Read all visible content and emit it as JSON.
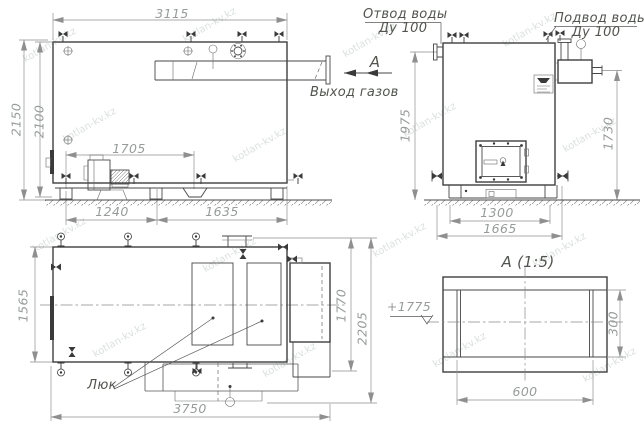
{
  "colors": {
    "background": "#ffffff",
    "main_line": "#3f3f3f",
    "dim_line": "#8f8f8f",
    "dim_text": "#979c99",
    "label_text": "#52554f",
    "watermark": "#a9b6ae"
  },
  "watermark": {
    "text": "kotlan-kv.kz"
  },
  "side_view": {
    "dims": {
      "w3115": "3115",
      "h2150": "2150",
      "h2100": "2100",
      "l1705": "1705",
      "l1240": "1240",
      "l1635": "1635"
    },
    "gas_outlet_label": "Выход газов",
    "view_arrow_label": "А"
  },
  "front_view": {
    "water_outlet_label": "Отвод воды",
    "water_outlet_dn": "Ду 100",
    "water_inlet_label": "Подвод воды",
    "water_inlet_dn": "Ду 100",
    "dims": {
      "h1975": "1975",
      "h1730": "1730",
      "b1300": "1300",
      "b1665": "1665"
    }
  },
  "plan_view": {
    "dims": {
      "w1565": "1565",
      "l3750": "3750",
      "r1770": "1770",
      "r2205": "2205"
    },
    "hatch_label": "Люк"
  },
  "detail_view": {
    "title": "А  (1:5)",
    "dims": {
      "w600": "600",
      "h300": "300"
    },
    "elevation_mark": "+1775"
  }
}
